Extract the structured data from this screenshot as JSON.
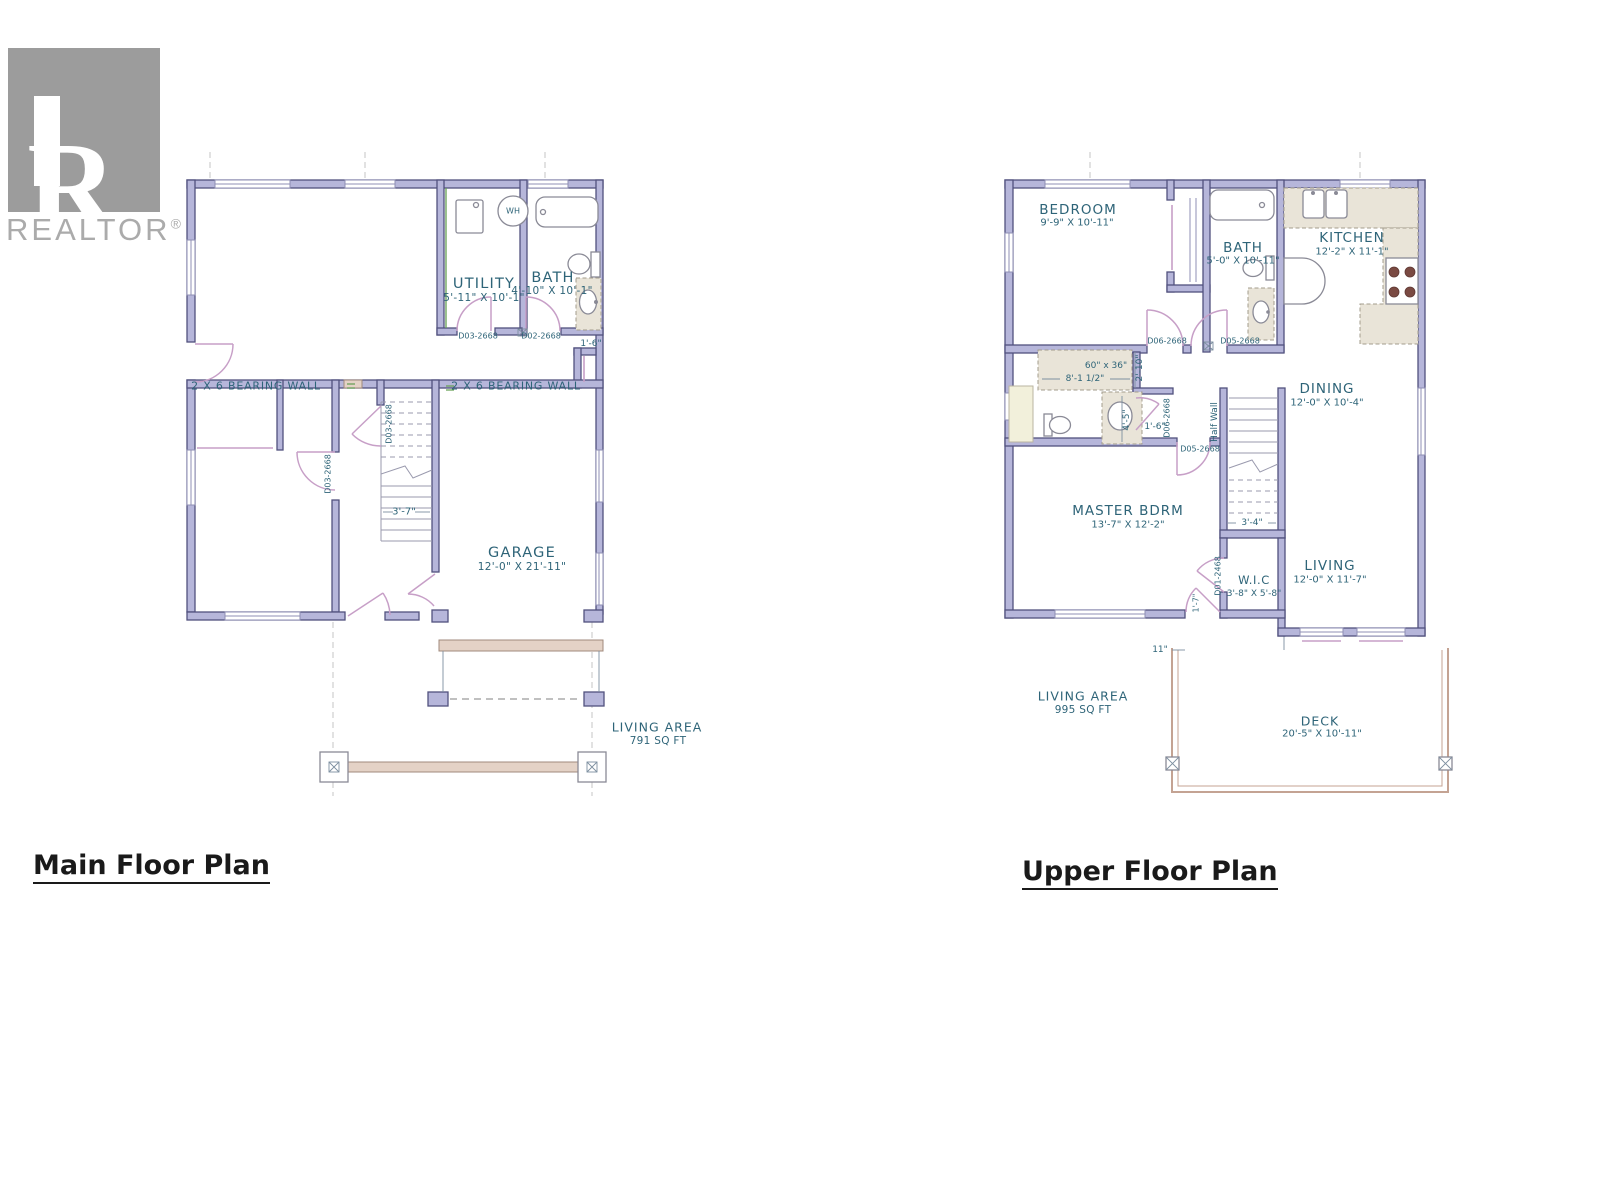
{
  "logo": {
    "letter_r": "R",
    "brand": "REALTOR",
    "reg": "®"
  },
  "titles": {
    "main": "Main Floor Plan",
    "upper": "Upper Floor Plan"
  },
  "colors": {
    "wall_fill": "#b6b6da",
    "wall_stroke": "#51517e",
    "label_teal": "#2e6478",
    "door_pink": "#c79fc7",
    "counter_fill": "#e9e4d8",
    "counter_stroke": "#a39c8d",
    "wood_fill": "#e4d2c6",
    "deck_rail": "#c4a393",
    "window_line": "#8f8fb4",
    "green_line": "#66a055",
    "logo_gray": "#9c9c9c",
    "logo_text": "#ababab",
    "title_ink": "#1a1a1a"
  },
  "main_floor": {
    "rooms": {
      "utility": {
        "name": "UTILITY",
        "dims": "5'-11\" X 10'-1\""
      },
      "bath": {
        "name": "BATH",
        "dims": "4'-10\" X 10'-1\""
      },
      "garage": {
        "name": "GARAGE",
        "dims": "12'-0\" X 21'-11\""
      }
    },
    "area": {
      "label": "LIVING AREA",
      "value": "791 SQ FT"
    },
    "labels": {
      "bearing_left": "2 X 6 BEARING WALL",
      "bearing_right": "2 X 6 BEARING WALL",
      "water_heater": "WH",
      "door_utility": "D03-2668",
      "door_bath": "D02-2668",
      "door_stair": "D03-2668",
      "door_bedroom": "D03-2668",
      "dim_side": "1'-6\"",
      "dim_stair": "3'-7\""
    }
  },
  "upper_floor": {
    "rooms": {
      "bedroom": {
        "name": "BEDROOM",
        "dims": "9'-9\" X 10'-11\""
      },
      "bath": {
        "name": "BATH",
        "dims": "5'-0\" X 10'-11\""
      },
      "kitchen": {
        "name": "KITCHEN",
        "dims": "12'-2\" X 11'-1\""
      },
      "dining": {
        "name": "DINING",
        "dims": "12'-0\" X 10'-4\""
      },
      "master": {
        "name": "MASTER BDRM",
        "dims": "13'-7\" X 12'-2\""
      },
      "wic": {
        "name": "W.I.C",
        "dims": "3'-8\" X 5'-8\""
      },
      "living": {
        "name": "LIVING",
        "dims": "12'-0\" X 11'-7\""
      },
      "deck": {
        "name": "DECK",
        "dims": "20'-5\" X 10'-11\""
      }
    },
    "area": {
      "label": "LIVING AREA",
      "value": "995 SQ FT"
    },
    "labels": {
      "door_bedroom": "D06-2668",
      "door_bath": "D05-2668",
      "door_ensuite": "D06-2668",
      "door_master": "D05-2668",
      "door_wic": "D01-2468",
      "tub_size": "60\" x 36\"",
      "dim_tub": "8'-1 1/2\"",
      "dim_tub_depth": "2'-10\"",
      "dim_vanity": "4'-5\"",
      "dim_hall": "1'-6\"",
      "half_wall": "Half Wall",
      "dim_stair": "3'-4\"",
      "dim_door": "1'-7\"",
      "dim_deck_offset": "11\""
    }
  }
}
